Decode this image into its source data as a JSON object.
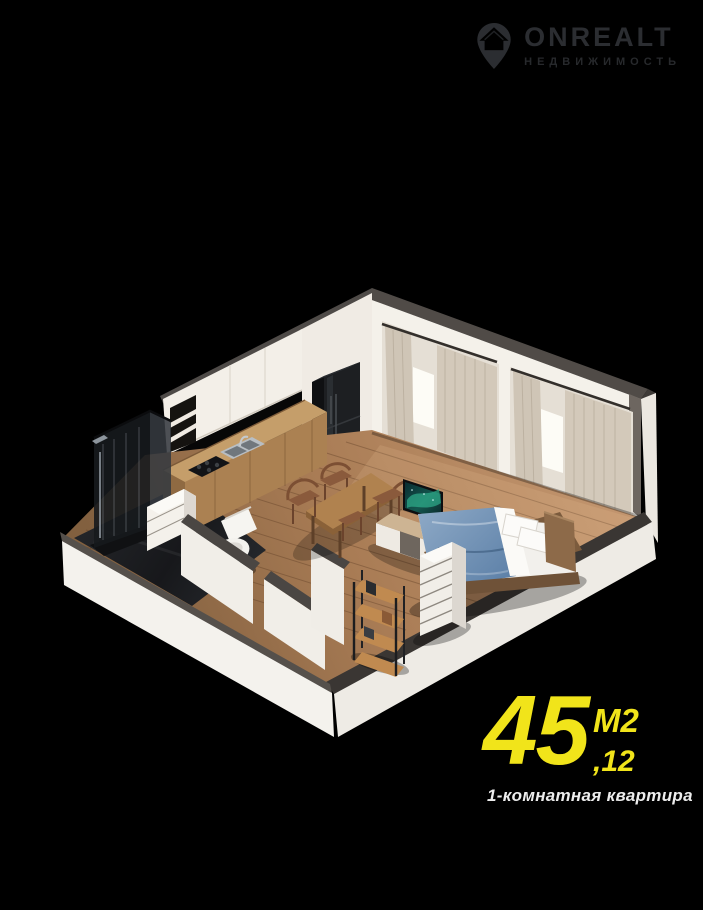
{
  "poster": {
    "background": "#000000"
  },
  "logo": {
    "brand": "ONREALT",
    "subtitle": "НЕДВИЖИМОСТЬ",
    "color": "#2b2d31",
    "icon": "location-pin-house-icon"
  },
  "area": {
    "integer": "45",
    "decimal": ",12",
    "unit": "М2",
    "color": "#f1e41a"
  },
  "caption": {
    "text": "1-комнатная квартира",
    "color": "#ededed"
  },
  "render": {
    "description": "3D isometric cutaway render of a one-room apartment: kitchen with upper cabinets and counter, fridge, shower, toilet, dining table with chairs, TV on stand, double bed with blue blanket, dresser and shelf rack, two curtained windows",
    "palette": {
      "floor_wood": "#b08457",
      "wall_white": "#f2efe9",
      "wall_cap": "#4a4643",
      "curtain": "#d0c6b7",
      "bathroom_tile": "#1b1d20",
      "bed_blanket": "#6c8fb4",
      "counter_wood": "#c59e6a",
      "tv_screen": "#2f9f84",
      "fridge": "#1d1f22"
    }
  }
}
